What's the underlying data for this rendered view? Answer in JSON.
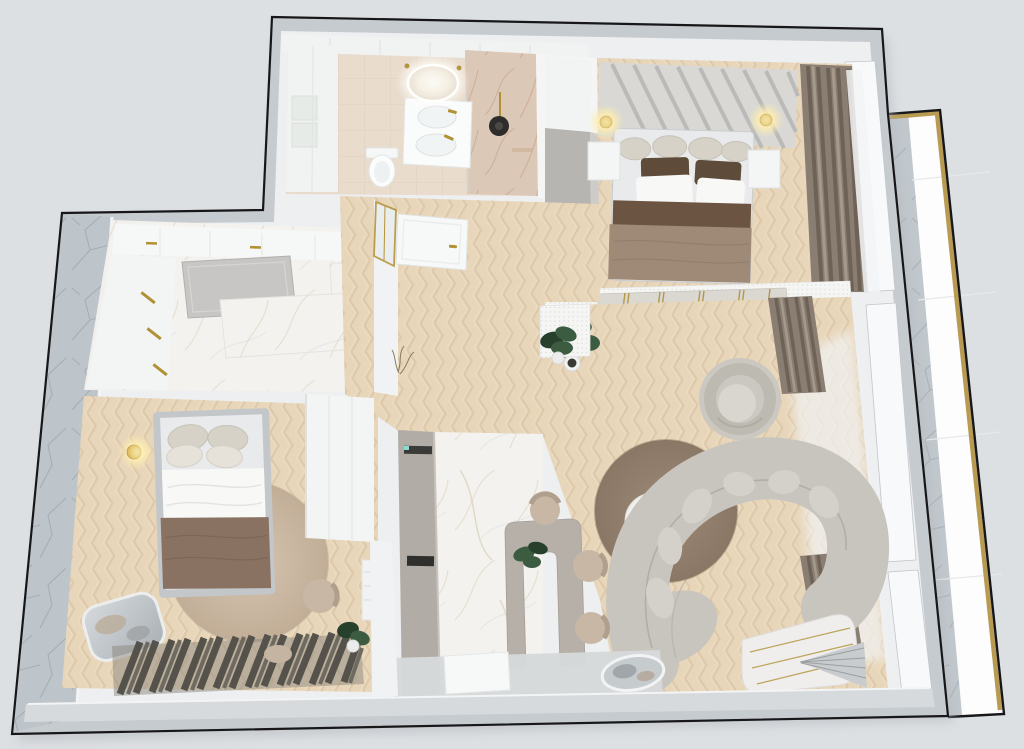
{
  "meta": {
    "description": "Photorealistic top-down 3D render of a one-bedroom apartment floor plan",
    "view": "top-down",
    "contains_text": false
  },
  "palette": {
    "bg": "#dde0e3",
    "outline": "#17171a",
    "wall_gray": "#c6cbcf",
    "wall_white": "#edeff1",
    "floor_gray": "#d6d9da",
    "bottom_band": "#d7dadc",
    "marble_wall": "#bec5ca",
    "marble_wall_vein": "#98a0a7",
    "marble_floor": "#f3f2ef",
    "marble_vein": "#d8cdb2",
    "bath_tile": "#e9dccd",
    "bath_tile_line": "#d8c7b5",
    "shower_marble": "#dcc8b6",
    "shower_vein": "#c29f86",
    "wood_base": "#e8d6ba",
    "wood_grain": "#d2bc9b",
    "gold": "#b09136",
    "glow_warm": "#ffeeb0",
    "curtain_dark": "#6e6257",
    "curtain_mid": "#8a7e72",
    "curtain_light": "#a5998c",
    "cabinet_taupe": "#b1aca6",
    "desk_taupe": "#b6b0a8",
    "gray_panel": "#c7c6c4",
    "wardrobe_gray": "#b7b5b1",
    "tv_black": "#15171a",
    "tv_panel": "#dbd8d2",
    "sofa": "#c8c5be",
    "sofa_seam": "#aaa79f",
    "sofa_cushion": "#d4d1ca",
    "armchair": "#cbc8c1",
    "armchair_ring": "#bdbab2",
    "rug_living_in": "#9c8976",
    "rug_living_out": "#8a7765",
    "rug_bed_in": "#d4c4b0",
    "rug_bed_out": "#c2ae97",
    "blanket_dark_brown": "#6b5441",
    "blanket_taupe": "#9f8a77",
    "blanket_brown": "#8a7263",
    "pillow_brown": "#5f4b39",
    "pillow_beige": "#d6d2c8",
    "linen_white": "#f8f8f7",
    "bed_frame_gray": "#c3c7ca",
    "mattress": "#e9eaeb",
    "mirror_silver_hi": "#d6dadd",
    "mirror_silver_lo": "#a9b0b5",
    "plant_green": "#3b5c41",
    "plant_green_dark": "#27402c",
    "slat_dark": "#55524b",
    "slat_mid": "#6e6a60",
    "chair_beige": "#c9b7a6",
    "chair_back": "#b19f8d",
    "white_furniture": "#f4f5f5",
    "perf_white": "#f5f6f4",
    "balcony_white": "#fdfdfd",
    "balcony_gold": "#b89a52",
    "headboard": "#d9d8d5",
    "headboard_stripe": "#b4b5b4"
  },
  "rooms": [
    {
      "id": "bathroom",
      "name": "Bathroom",
      "furniture": [
        "backlit-oval-mirror",
        "double-basin-vanity",
        "toilet",
        "marble-shower-column",
        "storage-shelves"
      ]
    },
    {
      "id": "bedroom-main",
      "name": "Main bedroom",
      "furniture": [
        "channel-headboard",
        "double-bed",
        "nightstand-left",
        "nightstand-right",
        "ceiling-lamp-left",
        "ceiling-lamp-right",
        "curtains",
        "wardrobe"
      ]
    },
    {
      "id": "tv-wall",
      "name": "Media wall",
      "furniture": [
        "perforated-screen-band",
        "tv-panel-gold-trim",
        "wall-tv",
        "media-console"
      ]
    },
    {
      "id": "living-room",
      "name": "Living room",
      "furniture": [
        "swivel-armchair",
        "round-rug",
        "coffee-table-small",
        "coffee-table-tray",
        "curved-sofa",
        "corner-curtain",
        "window-sheer",
        "arched-window-bench",
        "floor-mirror",
        "potted-plant"
      ]
    },
    {
      "id": "kitchen",
      "name": "Kitchen",
      "furniture": [
        "upper-counter-run",
        "gray-island-panel",
        "marble-countertop",
        "gold-handles"
      ]
    },
    {
      "id": "dining-nook",
      "name": "Dining nook",
      "furniture": [
        "tall-cabinet-run",
        "arch-desk",
        "dining-chairs",
        "doormat",
        "desk-plant"
      ]
    },
    {
      "id": "bedroom-second",
      "name": "Second bedroom",
      "furniture": [
        "single-bed",
        "round-rug",
        "wall-sconce",
        "leaning-mirror",
        "slatted-bench",
        "armchair",
        "wardrobe",
        "radiator",
        "plant"
      ]
    },
    {
      "id": "hallway",
      "name": "Hallway / entry",
      "furniture": [
        "entry-door",
        "glass-partition",
        "bedroom-door",
        "decor-twigs",
        "hall-plant"
      ]
    },
    {
      "id": "balcony",
      "name": "Balcony slab",
      "furniture": [
        "marble-pillar-strip",
        "gold-edge-trim"
      ]
    }
  ]
}
